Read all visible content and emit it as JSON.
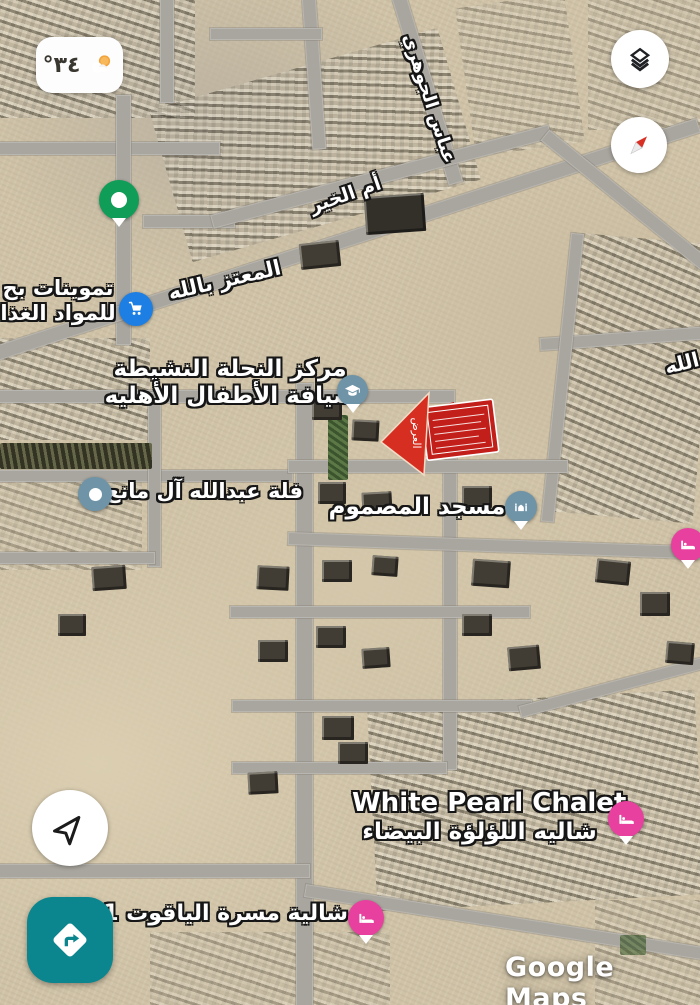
{
  "weather_chip": {
    "temperature": "°٣٤",
    "icon": "partly-cloudy-icon"
  },
  "map_controls": {
    "layers": "layers-icon",
    "compass": "compass-icon",
    "my_location": "navigation-arrow-icon",
    "directions": "directions-diamond-icon"
  },
  "streets": {
    "abbas_aljawhari": "عباس الجوهري",
    "um_alkhair": "أم الخير",
    "almutaz_billah": "المعتز بالله",
    "partial_right": "الله"
  },
  "places": {
    "tamwinat": {
      "line1": "تموينات بح",
      "line2": "للمواد الغذا",
      "icon": "shopping-cart-icon",
      "pin_color": "#1d7ee3"
    },
    "nahla_center": {
      "line1": "مركز النحلة النشيطة",
      "line2": "ضيافة الأطفال الأهليه",
      "icon": "graduation-cap-icon",
      "pin_color": "#6f94a7"
    },
    "villa_abdullah": {
      "label": "فلة عبدالله آل مانع",
      "icon": "dot-icon",
      "pin_color": "#6f94a7"
    },
    "masjid": {
      "label": "مسجد المصموم",
      "icon": "mosque-icon",
      "pin_color": "#6f94a7"
    },
    "white_pearl": {
      "line1": "White Pearl Chalet",
      "line2": "شاليه اللؤلؤة البيضاء",
      "icon": "bed-icon",
      "pin_color": "#e8409f"
    },
    "yaqoot": {
      "label": "شالية مسرة الياقوت 1",
      "icon": "bed-icon",
      "pin_color": "#e8409f"
    },
    "edge_lodging": {
      "icon": "bed-icon",
      "pin_color": "#e8409f"
    },
    "saved_place": {
      "icon": "green-dot-pin",
      "pin_color": "#0f9d58"
    }
  },
  "annotation": {
    "arrow_text": "العرض",
    "color": "#d62f22"
  },
  "watermark": "Google Maps",
  "colors": {
    "pin_blue": "#1d7ee3",
    "pin_slate": "#6f94a7",
    "pin_green": "#0f9d58",
    "pin_pink": "#e8409f",
    "annotation_red": "#d62f22",
    "directions_teal": "#0b858e"
  }
}
